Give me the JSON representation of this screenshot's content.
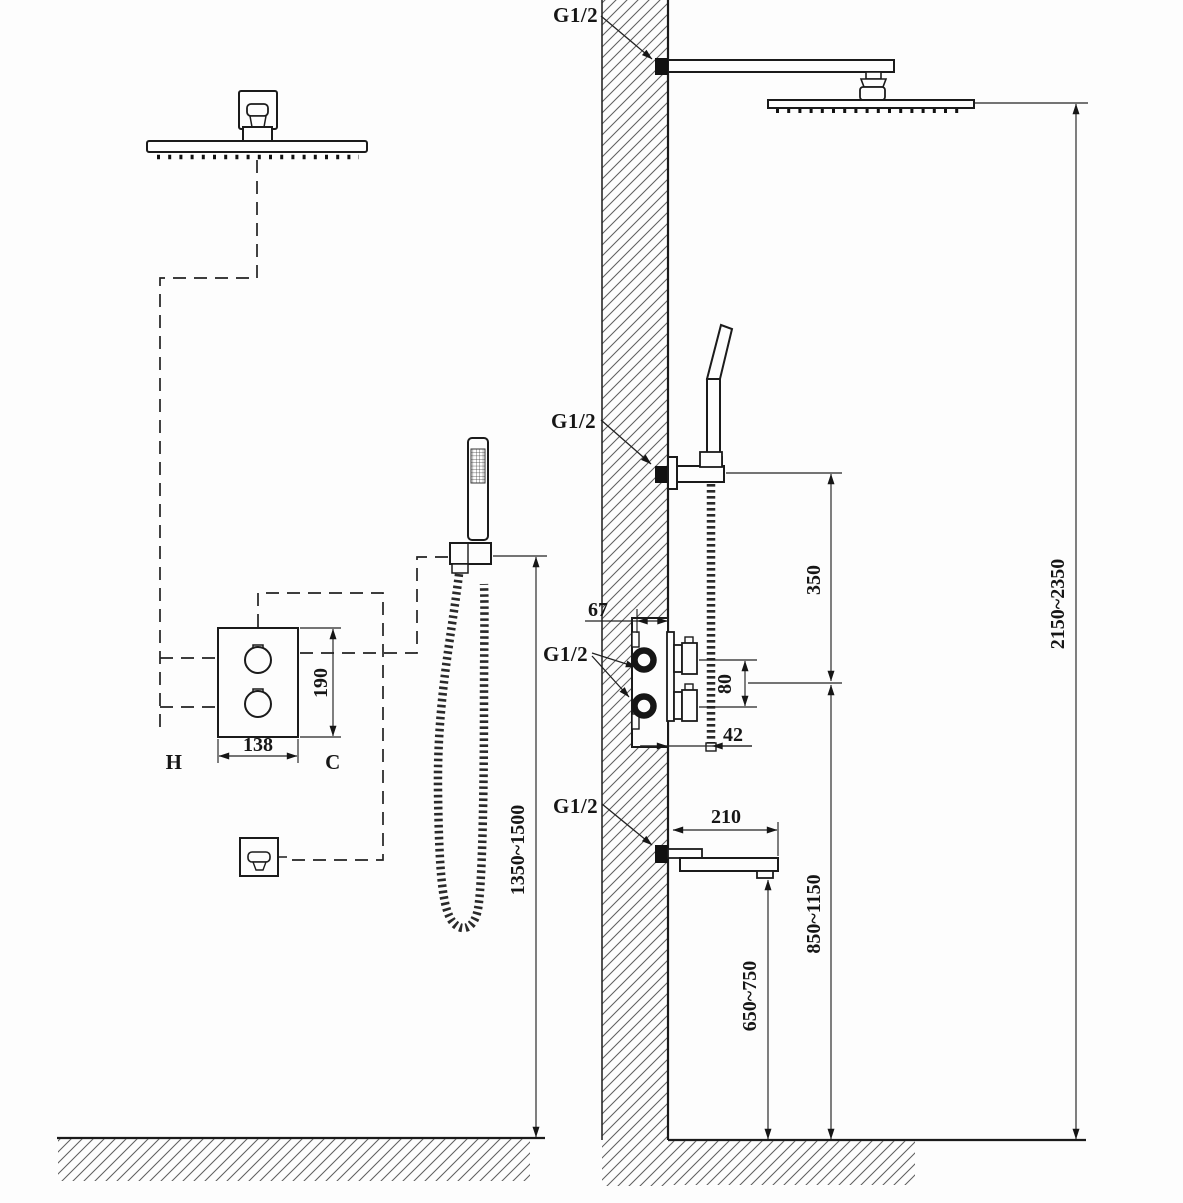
{
  "labels": {
    "connection": "G1/2",
    "hot": "H",
    "cold": "C"
  },
  "dimensions": {
    "valve_width": "138",
    "valve_height": "190",
    "handheld_outlet_height": "1350~1500",
    "overall_head_height": "2150~2350",
    "holder_above_valve": "350",
    "valve_port_spacing": "80",
    "valve_embed_depth": "67",
    "valve_face_offset": "42",
    "spout_reach": "210",
    "spout_height": "650~750",
    "valve_center_height": "850~1150"
  }
}
